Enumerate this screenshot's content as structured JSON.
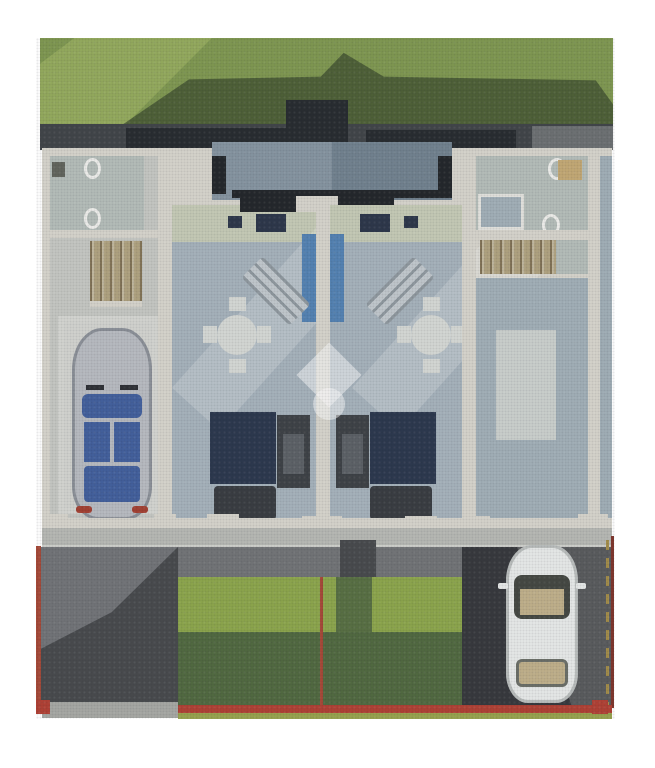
{
  "meta": {
    "description": "Scanned top-down 3D architectural render of two mirrored semi-detached housing units with furnished ground floors, rear lawn, front yards, a silver car with blue glazing parked in the left garage and a white car parked on the right driveway",
    "watermark_name": "diamond-and-dot watermark"
  },
  "objects": {
    "backLawn": "rear lawn",
    "backPavement": "rear pavement",
    "building": "building shell",
    "leftGarage": "left unit garage",
    "blueCar": "silver car with blue glazing",
    "leftBathroom": "left unit bathroom",
    "leftStairs": "left unit staircase",
    "terrace": "rear terrace",
    "kitchenLeft": "left unit kitchen",
    "kitchenRight": "right unit kitchen",
    "diningLeft": "left unit dining table",
    "diningRight": "right unit dining table",
    "rugLeft": "left unit area rug",
    "rugRight": "right unit area rug",
    "sofaLeft": "left unit sofa",
    "sofaRight": "right unit sofa",
    "tvLeft": "left unit tv cabinet",
    "tvRight": "right unit tv cabinet",
    "rightBathroom": "right unit bathroom",
    "rightStairs": "right unit staircase",
    "rightHall": "right unit garage hall",
    "frontSidewalk": "front sidewalk",
    "frontLawn": "front yard lawn",
    "driveLeft": "left driveway",
    "driveRight": "right driveway",
    "whiteCar": "white car",
    "fence": "red boundary fence",
    "watermark": "portal watermark"
  },
  "palette": {
    "paper": "#ffffff",
    "grassBack": "#7c9a44",
    "asphaltBack": "#3e4348",
    "asphaltBackDark": "#24292e",
    "asphaltBackLight": "#6b6f72",
    "wall": "#d9d7cd",
    "garageFloor": "#c7c9c4",
    "parkLight": "#d4d6d1",
    "bathFloor": "#b5bfba",
    "stairsWood": "#b3a379",
    "terrace": "#8395a4",
    "terraceDark": "#6e8292",
    "kitchenFloor": "#c6cdb4",
    "livingFloor": "#a5b4c0",
    "livingLight": "#c2cad0",
    "counterNavy": "#28344b",
    "cabinetBlue": "#4b83be",
    "rugNavy": "#273550",
    "tvGray": "#3b3f45",
    "tvScreen": "#5a6066",
    "sofaDark": "#363a40",
    "tableLight": "#d7dbd7",
    "hallFloor": "#a0b1bb",
    "hallRug": "#ccd3cf",
    "unitStrip": "#9fb0ba",
    "doorDark": "#1f2328",
    "sidewalk": "#b8bab5",
    "sidewalkBottom": "#a7a9a4",
    "fenceLine": "#d2d4cf",
    "driveLeftAsphalt": "#45484c",
    "midAsphalt": "#707376",
    "driveRightAsphalt": "#57595c",
    "grassFrontBright": "#8aa93c",
    "grassFrontDark": "#4c6938",
    "grassFrontNotch": "#53703a",
    "grassFrontStrip": "#98a63e",
    "fenceRed": "#b5432e",
    "postRed": "#c23a2b",
    "fenceDarkRed": "#8a3025",
    "fenceYellow": "#a98f3c",
    "carSilver": "#b9bdc4",
    "carGlass": "#3b5fa9",
    "carDetailDark": "#2b2e34",
    "tailRed": "#b23a28",
    "carWhite": "#eaedec",
    "carTan": "#c4b184",
    "windshieldDark": "#42463f",
    "fixtureDark": "#60645a",
    "shelfTan": "#c9a96a",
    "sinkBlue": "#3f6db5",
    "watermark": "rgba(255,255,255,0.5)"
  }
}
